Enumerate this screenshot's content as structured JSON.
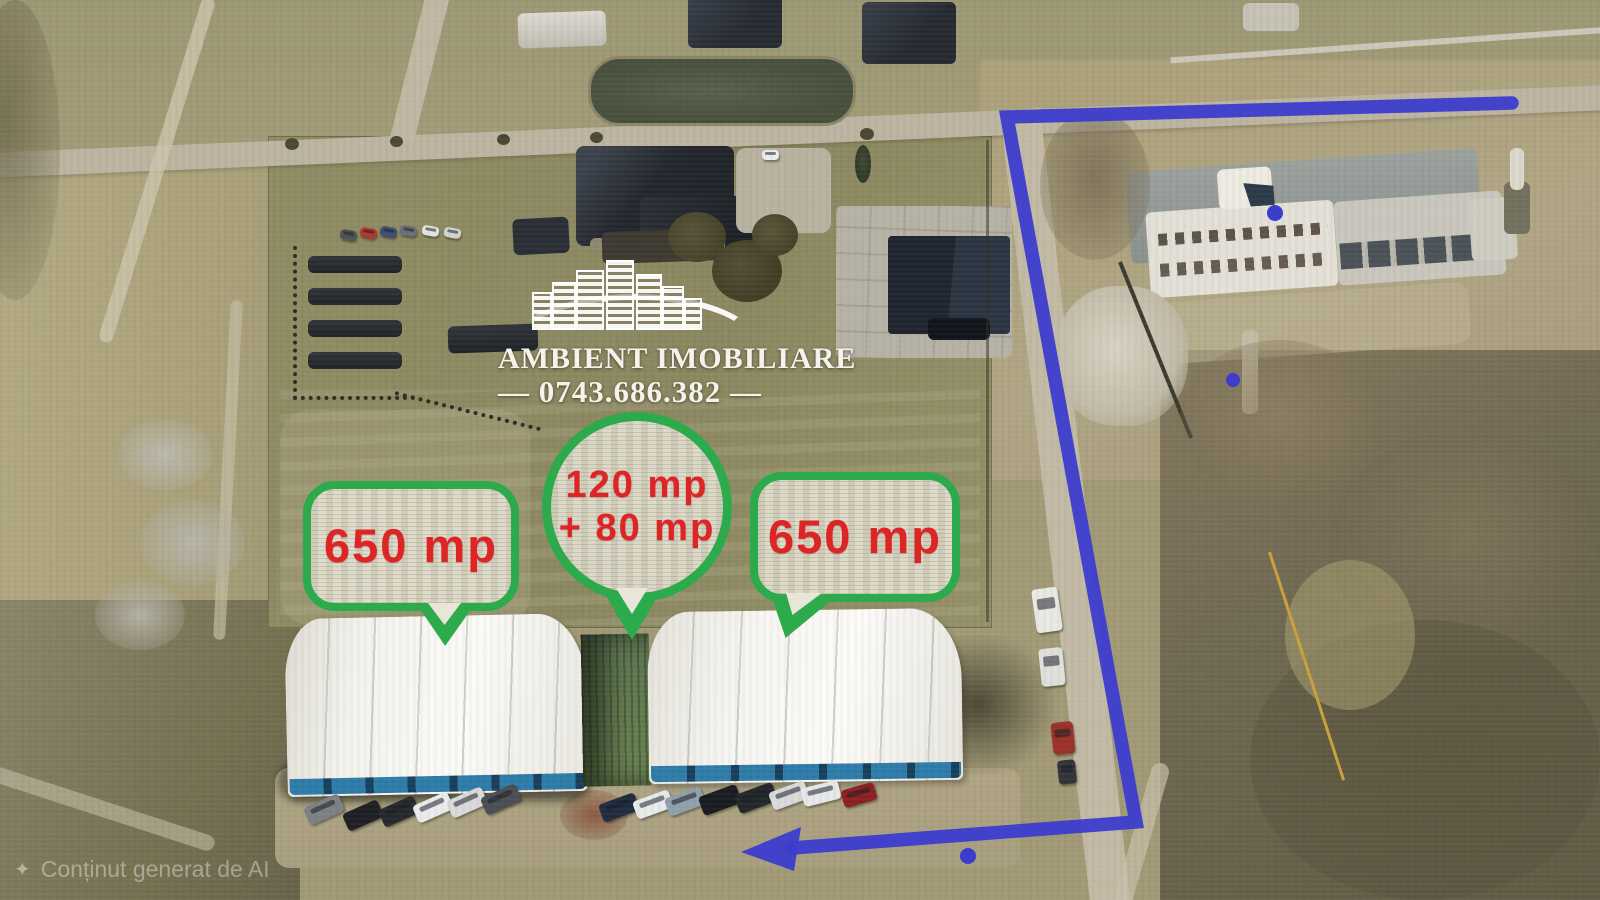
{
  "image_type": "aerial-drone-photo-real-estate",
  "watermark": {
    "brand_name": "AMBIENT IMOBILIARE",
    "phone_display": "— 0743.686.382 —",
    "logo_icon": "apartment-buildings-skyline"
  },
  "area_labels": {
    "left_parcel": "650 mp",
    "center_parcel_line1": "120 mp",
    "center_parcel_line2": "+ 80 mp",
    "right_parcel": "650 mp"
  },
  "footer": {
    "ai_caption": "Conținut generat de AI",
    "sparkle_icon": "✦"
  },
  "colors": {
    "bubble_border_green": "#2daa4b",
    "label_red": "#dd2525",
    "route_blue": "#3c3ccd"
  },
  "route_arrow": {
    "line_points": "1512,103 1007,117 1136,822 792,848",
    "arrowhead_points": "741,852 801,827 794,871",
    "dots": [
      {
        "x": 1275,
        "y": 213,
        "r": 8
      },
      {
        "x": 1233,
        "y": 380,
        "r": 7
      },
      {
        "x": 968,
        "y": 856,
        "r": 8
      }
    ]
  }
}
